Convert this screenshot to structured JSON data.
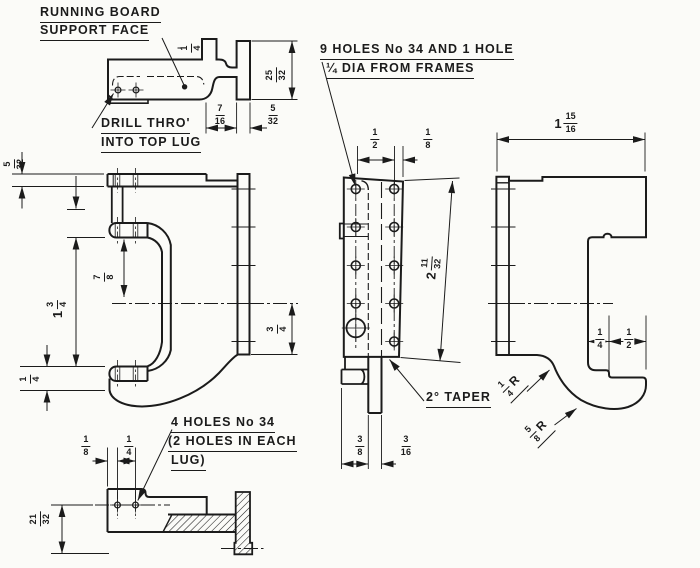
{
  "labels": {
    "running_board": {
      "l1": "RUNNING BOARD",
      "l2": "SUPPORT FACE"
    },
    "drill": {
      "l1": "DRILL THRO'",
      "l2": "INTO TOP LUG"
    },
    "nine_holes": {
      "l1": "9 HOLES No 34 AND 1 HOLE",
      "l2": "¼ DIA FROM FRAMES"
    },
    "four_holes": {
      "l1": "4 HOLES No 34",
      "l2": "(2 HOLES IN EACH",
      "l3": "LUG)"
    },
    "taper": "2° TAPER"
  },
  "dims": {
    "a14": {
      "n": "1",
      "d": "4"
    },
    "a2532": {
      "n": "25",
      "d": "32"
    },
    "a716": {
      "n": "7",
      "d": "16"
    },
    "a532": {
      "n": "5",
      "d": "32"
    },
    "b532": {
      "n": "5",
      "d": "32"
    },
    "b78": {
      "n": "7",
      "d": "8"
    },
    "b134": {
      "w": "1",
      "n": "3",
      "d": "4"
    },
    "b34": {
      "n": "3",
      "d": "4"
    },
    "b14": {
      "n": "1",
      "d": "4"
    },
    "c12": {
      "n": "1",
      "d": "2"
    },
    "c18": {
      "n": "1",
      "d": "8"
    },
    "c21132": {
      "w": "2",
      "n": "11",
      "d": "32"
    },
    "c38": {
      "n": "3",
      "d": "8"
    },
    "c316": {
      "n": "3",
      "d": "16"
    },
    "d11516": {
      "w": "1",
      "n": "15",
      "d": "16"
    },
    "d14": {
      "n": "1",
      "d": "4"
    },
    "d12": {
      "n": "1",
      "d": "2"
    },
    "e18": {
      "n": "1",
      "d": "8"
    },
    "e14": {
      "n": "1",
      "d": "4"
    },
    "e2132": {
      "n": "21",
      "d": "32"
    },
    "r14": {
      "n": "1",
      "d": "4",
      "s": "R"
    },
    "r58": {
      "n": "5",
      "d": "8",
      "s": "R"
    }
  },
  "colors": {
    "ink": "#1b1b1b",
    "paper": "#fbfbf8"
  }
}
